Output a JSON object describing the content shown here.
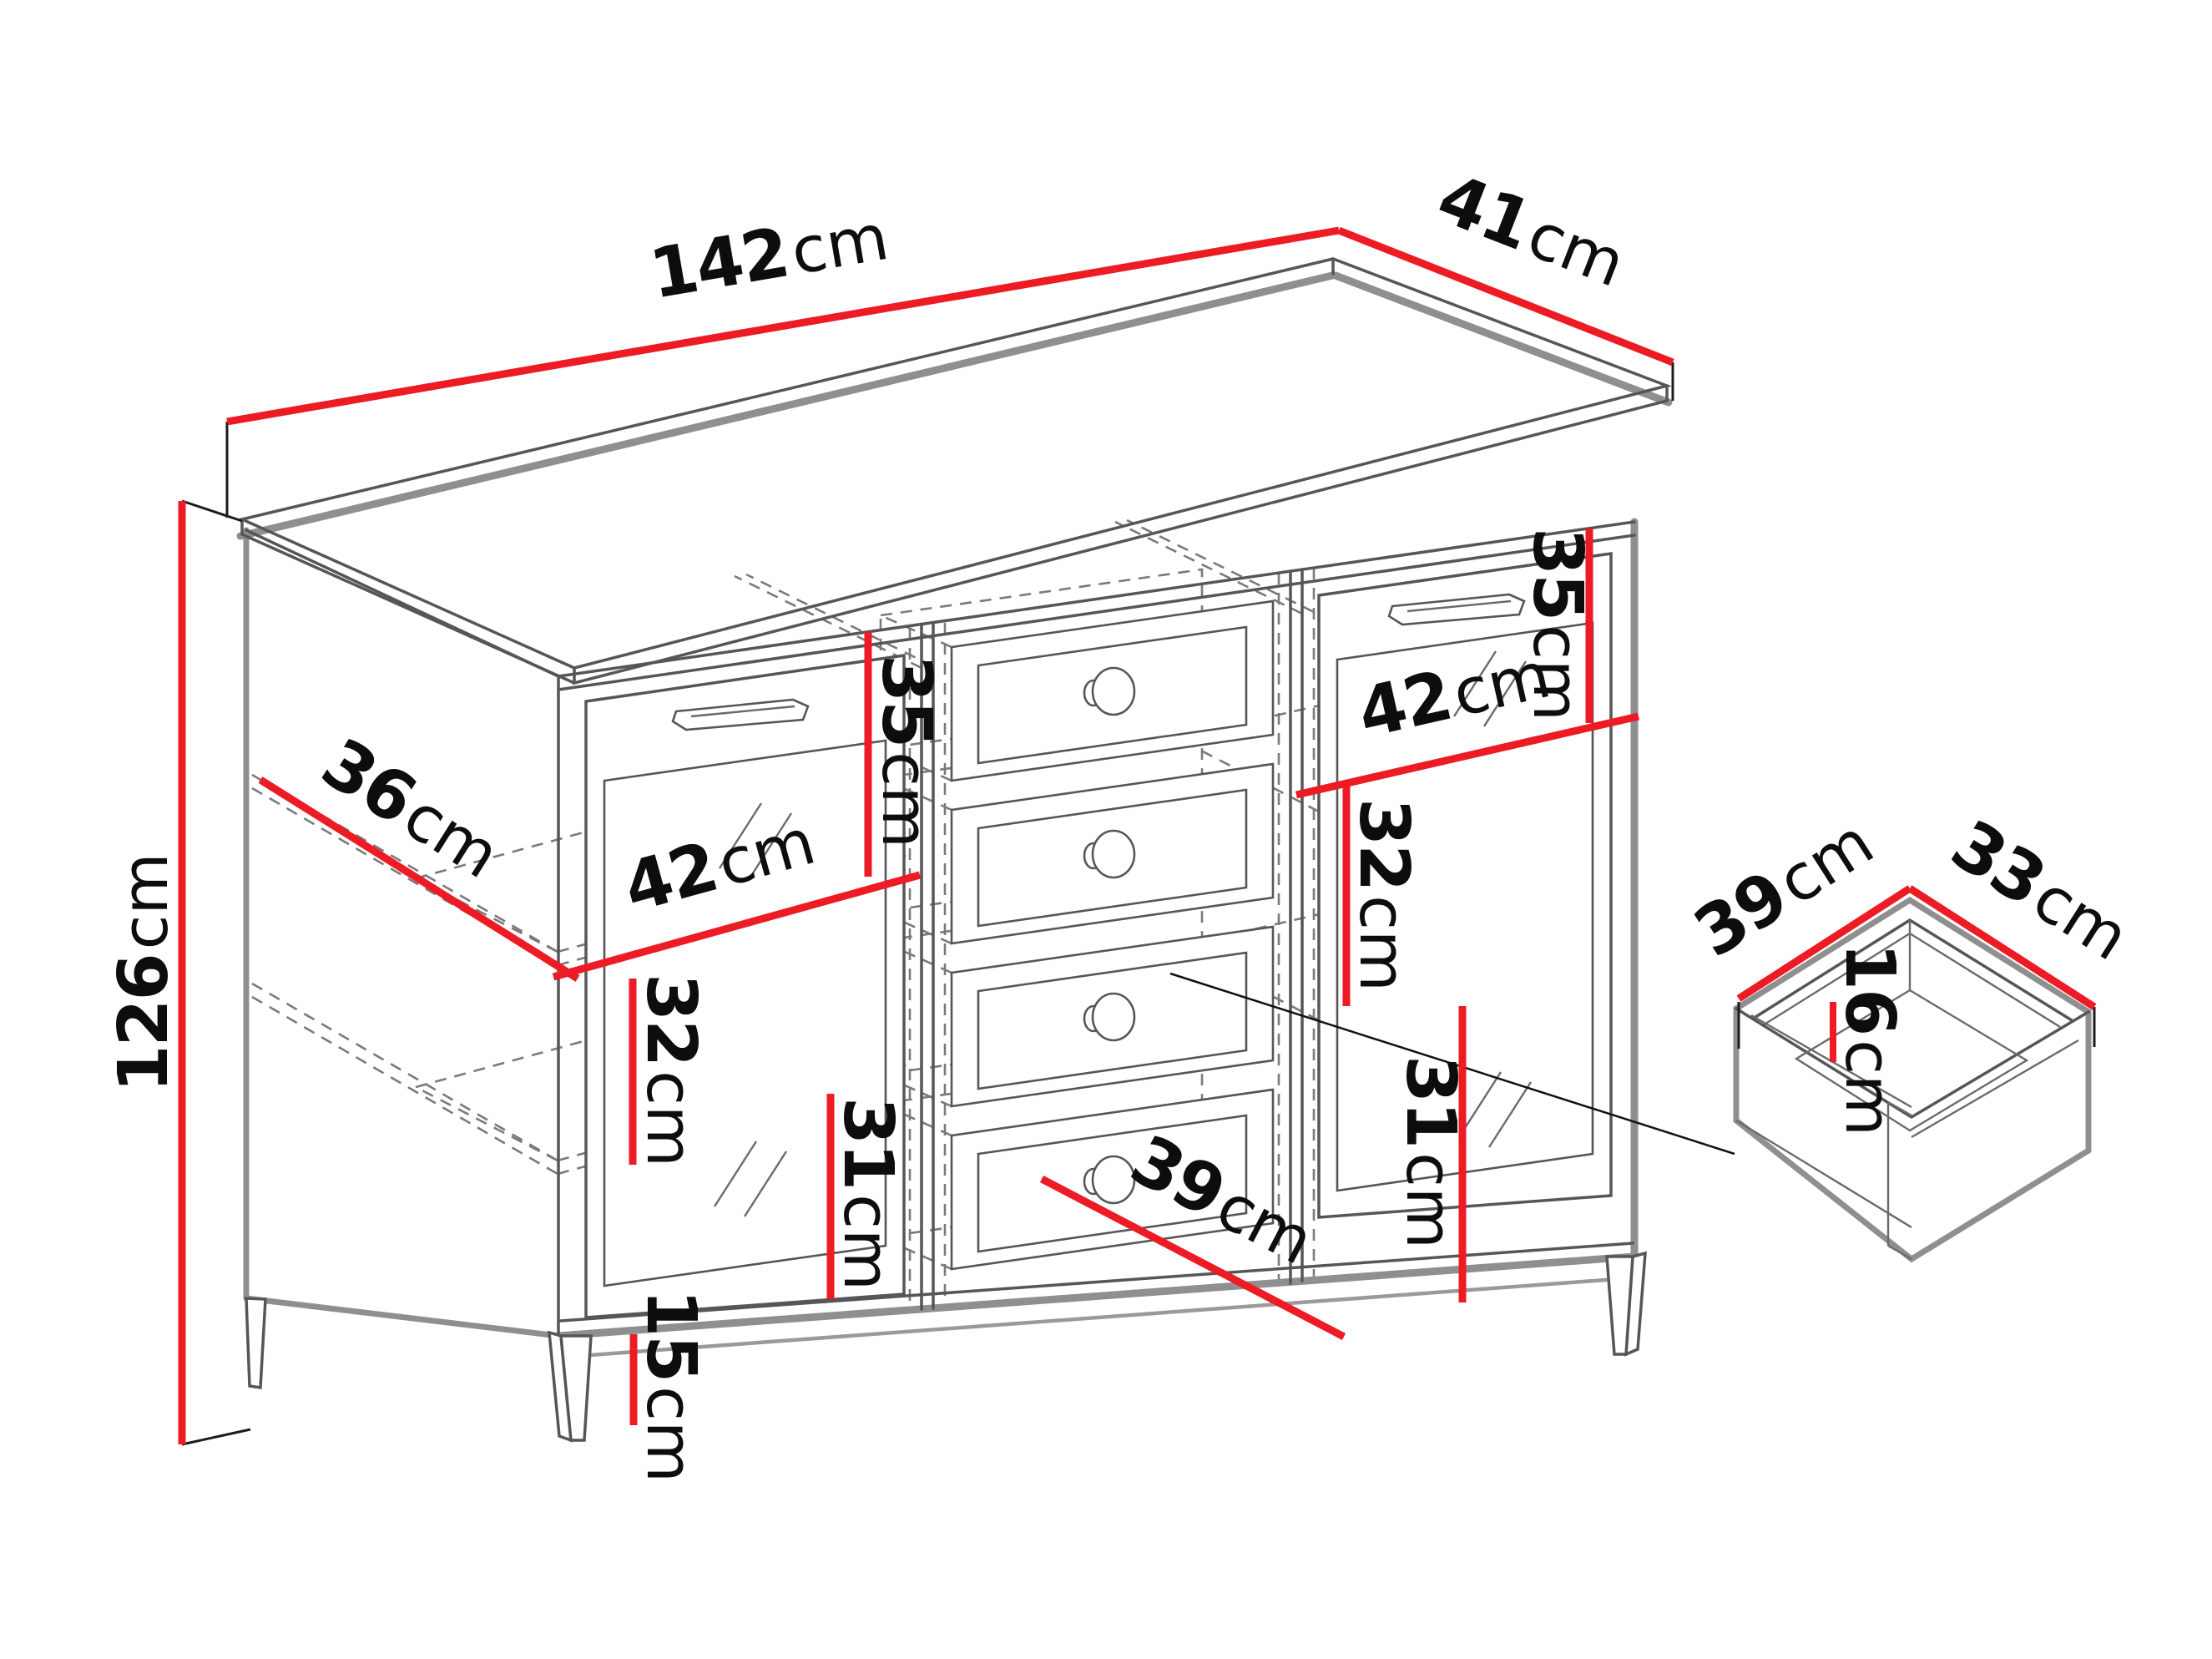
{
  "diagram": {
    "type": "furniture-dimension-drawing",
    "background": "#ffffff",
    "accent_red": "#ec1b24",
    "outline_gray": "#8f8f8f",
    "detail_gray": "#565656",
    "dash_gray": "#7a7a7a",
    "label_color": "#0d0d0d"
  },
  "labels": {
    "width": {
      "value": "142",
      "unit": "cm"
    },
    "depth": {
      "value": "41",
      "unit": "cm"
    },
    "height": {
      "value": "126",
      "unit": "cm"
    },
    "shelf_depth": {
      "value": "36",
      "unit": "cm"
    },
    "left_section_width": {
      "value": "42",
      "unit": "cm"
    },
    "left_top_height": {
      "value": "35",
      "unit": "cm"
    },
    "left_middle_height": {
      "value": "32",
      "unit": "cm"
    },
    "left_bottom_height": {
      "value": "31",
      "unit": "cm"
    },
    "leg_height": {
      "value": "15",
      "unit": "cm"
    },
    "right_section_width": {
      "value": "42",
      "unit": "cm"
    },
    "right_top_height": {
      "value": "35",
      "unit": "cm"
    },
    "right_middle_height": {
      "value": "32",
      "unit": "cm"
    },
    "right_bottom_height": {
      "value": "31",
      "unit": "cm"
    },
    "drawer_opening_width": {
      "value": "39",
      "unit": "cm"
    },
    "drawer_box_depth": {
      "value": "39",
      "unit": "cm"
    },
    "drawer_box_width": {
      "value": "33",
      "unit": "cm"
    },
    "drawer_box_height": {
      "value": "16",
      "unit": "cm"
    }
  }
}
